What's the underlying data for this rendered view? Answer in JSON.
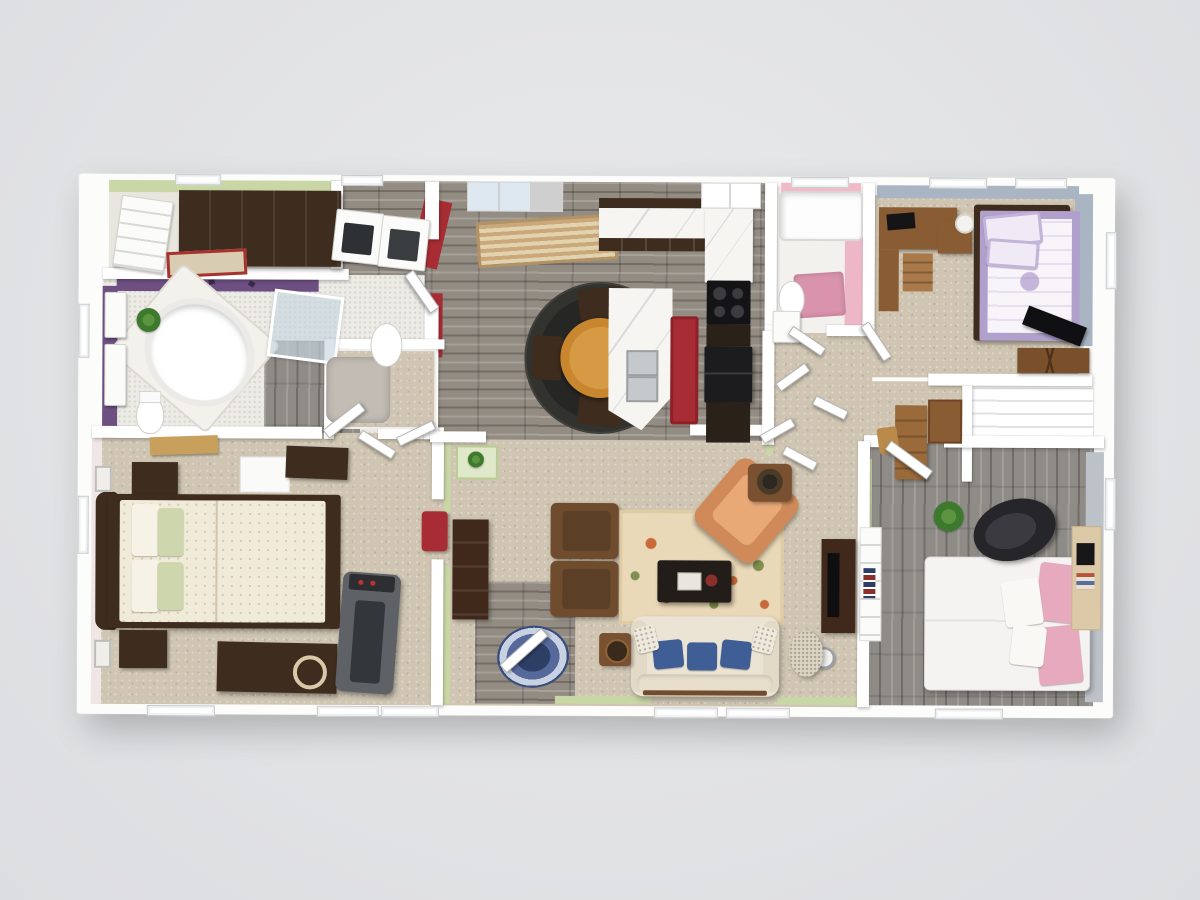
{
  "scene": {
    "type": "3d-dollhouse-floorplan-render",
    "view": "top-down cutaway of a single-story 3-bedroom 2-bath home, no visible text or UI chrome",
    "background_color": "#e2e3e5"
  },
  "palette": {
    "bg": "#e2e3e5",
    "wall": "#ffffff",
    "sage": "#c9d6a6",
    "sage_light": "#dfe8c8",
    "purple": "#6d4f82",
    "red": "#a72c33",
    "pink_wall": "#f2bac9",
    "pink_rug": "#d993ad",
    "bluegray": "#a9b5c3",
    "graywall": "#bdc2c9",
    "carpet": "#cfc5b2",
    "stone": "#938c83",
    "graywood": "#8f8c87",
    "darkwood": "#3e2c1e",
    "wood": "#6f4c2d",
    "wood_light": "#c8a05c",
    "table_orange": "#c8862f",
    "marble": "#f6f5f2",
    "sofa": "#ebe3d4",
    "blue_pillow": "#3e5e95",
    "rug_base": "#ead9b8",
    "lavender": "#b0a0cc",
    "pink_pillow": "#e7a9bd",
    "duvet": "#f0ead9",
    "sage_pillow": "#cdd6ad",
    "black": "#1b1b1e",
    "treadmill": "#5e6266"
  },
  "rooms": [
    {
      "name": "walk-in-closet",
      "wall_color": "#c9d6a6",
      "floor": "carpet",
      "furniture": [
        "dark-wood-shelving",
        "built-in-dresser",
        "bordered-rug"
      ]
    },
    {
      "name": "laundry-room",
      "wall_color": "#a72c33",
      "floor": "stone-tile",
      "furniture": [
        "washer",
        "dryer"
      ]
    },
    {
      "name": "master-bathroom",
      "wall_color": "#6d4f82",
      "floor": "mosaic-tile",
      "furniture": [
        "corner-garden-tub",
        "glass-shower",
        "toilet",
        "double-vanity",
        "pedestal-sink",
        "potted-plant",
        "shag-rug"
      ]
    },
    {
      "name": "master-bedroom",
      "wall_color": "#f0e6e6",
      "floor": "carpet",
      "furniture": [
        "queen-bed-floral-bedding",
        "nightstand",
        "nightstand",
        "dresser",
        "white-table",
        "media-chest",
        "treadmill",
        "wall-art",
        "bench"
      ]
    },
    {
      "name": "kitchen",
      "wall_color": "#c9d6a6",
      "floor": "stone-tile",
      "furniture": [
        "l-shaped-marble-counter",
        "cooktop",
        "refrigerator",
        "island-with-sink",
        "red-runner-rug",
        "pantry",
        "window-with-blinds"
      ]
    },
    {
      "name": "dining-nook",
      "wall_color": "#a72c33",
      "floor": "stone-tile",
      "furniture": [
        "round-braided-rug",
        "round-table",
        "four-chairs",
        "striped-runner-rug"
      ]
    },
    {
      "name": "living-room",
      "wall_color": "#c9d6a6",
      "floor": "carpet",
      "furniture": [
        "cream-sofa-blue-pillows",
        "two-brown-armchairs",
        "orange-armchair",
        "red-accent-chair",
        "coffee-table",
        "floral-area-rug",
        "media-console",
        "oval-braided-entry-rug",
        "side-tables",
        "decorative-pouf",
        "telephone-table-with-plant"
      ]
    },
    {
      "name": "hall-bathroom",
      "wall_color": "#f2bac9",
      "floor": "white-tile",
      "furniture": [
        "tub",
        "toilet",
        "vanity",
        "pink-rug"
      ]
    },
    {
      "name": "hallway",
      "wall_color": "#c9d6a6",
      "floor": "carpet",
      "furniture": [
        "writing-desk",
        "chair",
        "wall-hutch",
        "linen-closet"
      ]
    },
    {
      "name": "bedroom-2",
      "wall_color": "#a9b5c3",
      "floor": "carpet",
      "furniture": [
        "bed-lavender-quilt",
        "corner-desk-with-laptop",
        "nightstand-with-lamp",
        "tv-on-stand",
        "closet-with-shelves"
      ]
    },
    {
      "name": "bedroom-3",
      "wall_color": "#bdc2c9",
      "floor": "gray-plank-wood",
      "furniture": [
        "bed-pink-pillows",
        "black-lounge-chair",
        "wall-desk-with-laptop",
        "white-bookshelf",
        "potted-plant",
        "tv-console"
      ]
    }
  ]
}
